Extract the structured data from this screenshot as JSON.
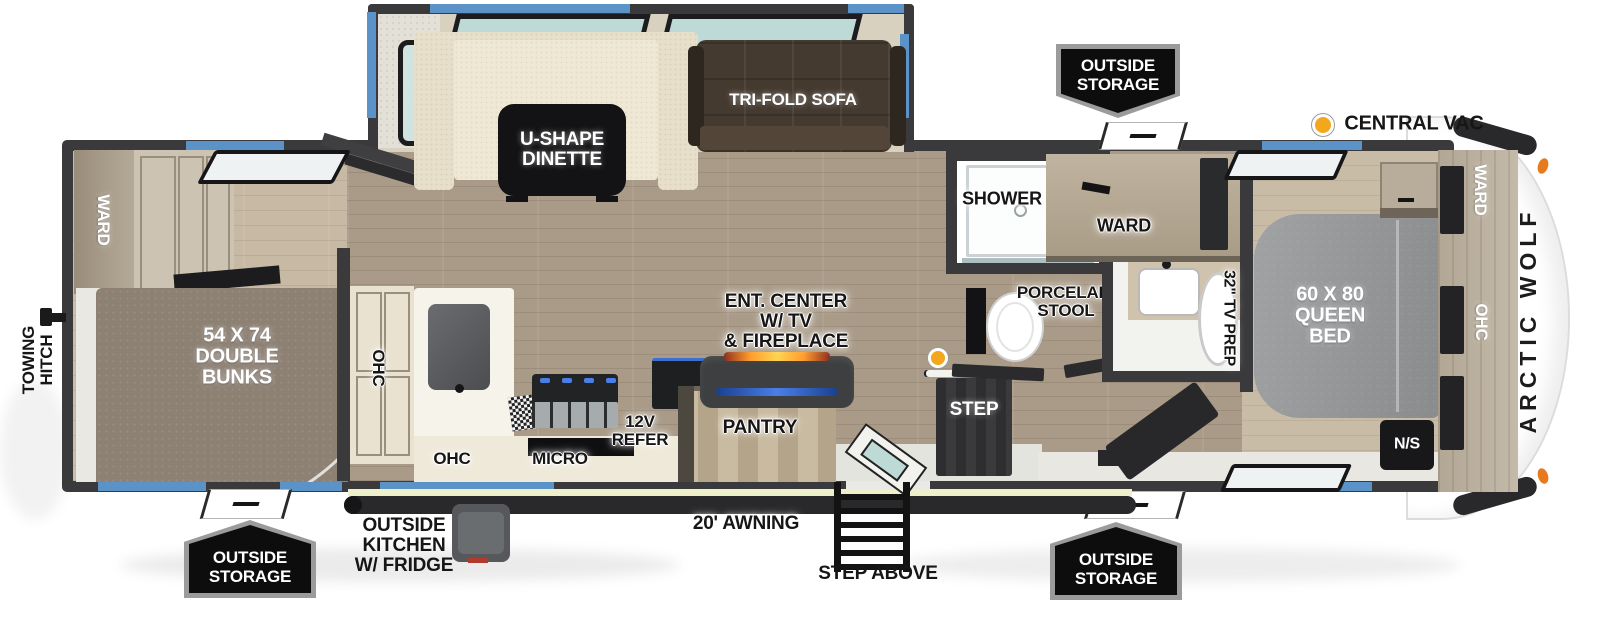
{
  "title": "Arctic Wolf travel trailer floor plan",
  "exterior": {
    "brand": "ARCTIC WOLF",
    "central_vac": "CENTRAL VAC",
    "towing_hitch": "TOWING\nHITCH",
    "awning": "20' AWNING",
    "step_above": "STEP ABOVE",
    "outside_kitchen": "OUTSIDE\nKITCHEN\nW/ FRIDGE",
    "storage_badges": [
      "OUTSIDE\nSTORAGE",
      "OUTSIDE\nSTORAGE",
      "OUTSIDE\nSTORAGE"
    ]
  },
  "rooms": {
    "bunk": {
      "ward": "WARD",
      "bunks": "54 X 74\nDOUBLE\nBUNKS"
    },
    "living": {
      "dinette": "U-SHAPE\nDINETTE",
      "sofa": "TRI-FOLD SOFA",
      "ent_center": "ENT. CENTER\nW/ TV\n& FIREPLACE",
      "pantry": "PANTRY",
      "step": "STEP"
    },
    "kitchen": {
      "ohc_upper": "OHC",
      "ohc_lower": "OHC",
      "micro": "MICRO",
      "refer": "12V\nREFER"
    },
    "bath": {
      "shower": "SHOWER",
      "stool": "PORCELAIN\nSTOOL",
      "ward": "WARD"
    },
    "bedroom": {
      "tv_prep": "32\" TV PREP",
      "bed": "60 X 80\nQUEEN\nBED",
      "ward": "WARD",
      "ohc": "OHC",
      "nightstand": "N/S"
    }
  },
  "colors": {
    "wall": "#3a3a3c",
    "window_blue": "#5b93c9",
    "glass_teal": "#bedad7",
    "floor_light": "#c7b9a3",
    "floor_mid": "#a99b88",
    "vac_yellow": "#f2a71d",
    "clearance_orange": "#e87a1e",
    "fireplace_orange": "#ff9d2e",
    "tv_blue": "#4a7fe8",
    "awning_pale": "#edf0cb",
    "badge_black": "#0d0d0d",
    "badge_border": "#9b9b9b"
  }
}
